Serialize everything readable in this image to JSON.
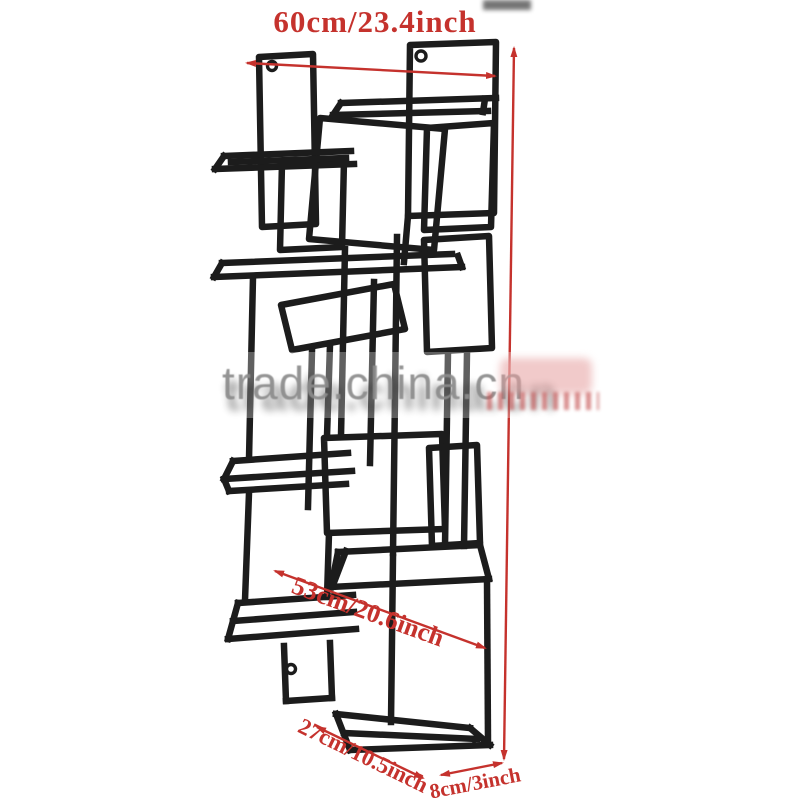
{
  "figure": {
    "type": "product-dimension-diagram",
    "subject": "wall-mounted interlocking-rectangles metal shelf rack"
  },
  "labels": {
    "width": "60cm/23.4inch",
    "diagonal": "53cm/20.6inch",
    "depth": "27cm/10.5inch",
    "side": "8cm/3inch"
  },
  "watermark": {
    "text": "trade.china.cn"
  },
  "colors": {
    "annotation_red": "#c5322d",
    "metal_black": "#1c1c1c",
    "watermark_gray": "#8c8c8c",
    "background": "#ffffff"
  }
}
